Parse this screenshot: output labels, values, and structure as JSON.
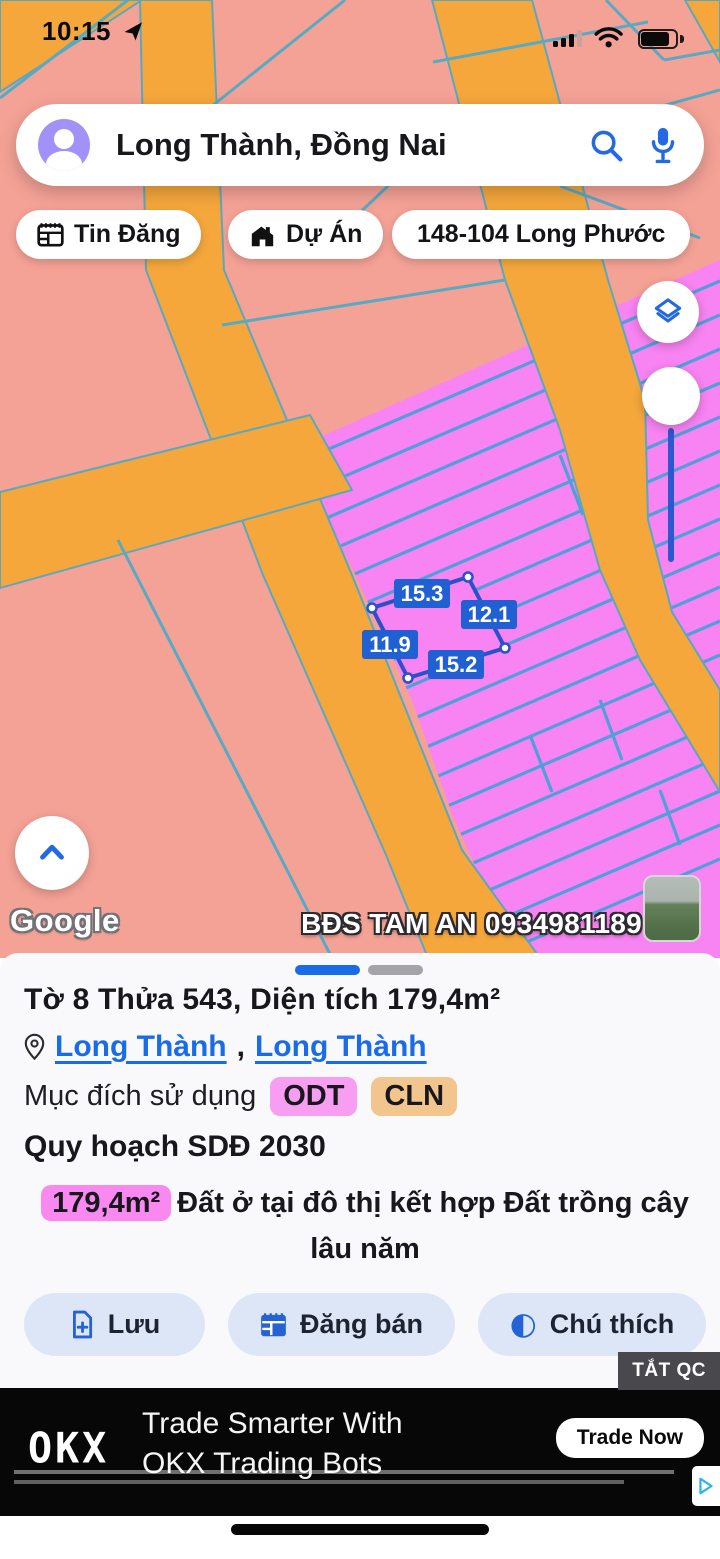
{
  "status_bar": {
    "time": "10:15"
  },
  "search": {
    "query": "Long Thành, Đồng Nai"
  },
  "chips": {
    "posts": "Tin Đăng",
    "projects": "Dự Án",
    "parcel": "148-104 Long Phước"
  },
  "map": {
    "attribution": "Google",
    "watermark": "BĐS TAM AN 0934981189",
    "selected_parcel": {
      "edge_labels": [
        "15.3",
        "12.1",
        "11.9",
        "15.2"
      ]
    },
    "colors": {
      "land_base": "#f5a296",
      "road": "#f5a73c",
      "planned_zone": "#f883f2",
      "boundary_line": "#58a9c4",
      "selection_blue": "#2b50c8",
      "accent_blue": "#2563d4"
    }
  },
  "sheet": {
    "title": "Tờ 8 Thửa 543, Diện tích 179,4m²",
    "location": {
      "link1": "Long Thành",
      "separator": ",",
      "link2": "Long Thành"
    },
    "land_use_label": "Mục đích sử dụng",
    "land_use_codes": {
      "odt": "ODT",
      "cln": "CLN"
    },
    "planning": "Quy hoạch SDĐ 2030",
    "area_badge": "179,4m²",
    "description": "Đất ở tại đô thị kết hợp Đất trồng cây lâu năm",
    "buttons": {
      "save": "Lưu",
      "sell": "Đăng bán",
      "legend": "Chú thích"
    },
    "dismiss_ad": "TẮT QC"
  },
  "ad": {
    "brand": "OKX",
    "headline1": "Trade Smarter With",
    "headline2": "OKX Trading Bots",
    "cta": "Trade Now"
  }
}
